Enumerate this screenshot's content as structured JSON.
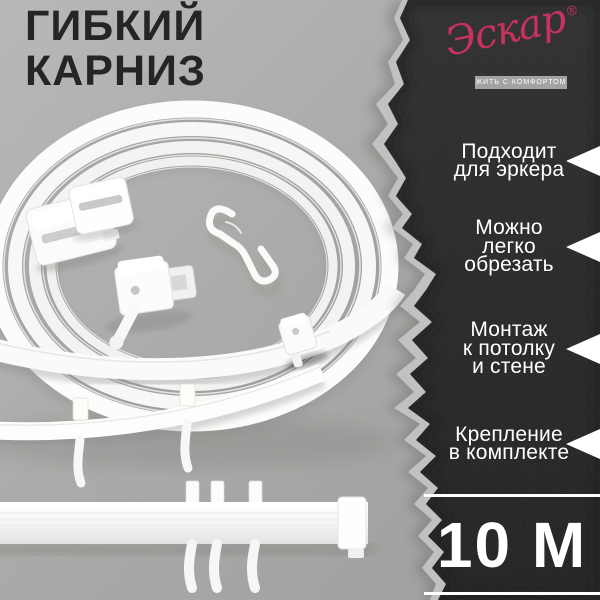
{
  "page": {
    "background_color": "#a9a8a6"
  },
  "title": {
    "text": "ГИБКИЙ\nКАРНИЗ",
    "color": "#252525"
  },
  "brand": {
    "name": "Эскар",
    "registered": "®",
    "tagline": "ЖИТЬ С КОМФОРТОМ",
    "accent_color": "#c9325f"
  },
  "features": [
    {
      "label": "Подходит\nдля эркера"
    },
    {
      "label": "Можно\nлегко\nобрезать"
    },
    {
      "label": "Монтаж\nк потолку\nи стене"
    },
    {
      "label": "Крепление\nв комплекте"
    }
  ],
  "length_badge": {
    "value": "10 М"
  },
  "panel": {
    "color": "#232323",
    "text_color": "#ffffff"
  }
}
